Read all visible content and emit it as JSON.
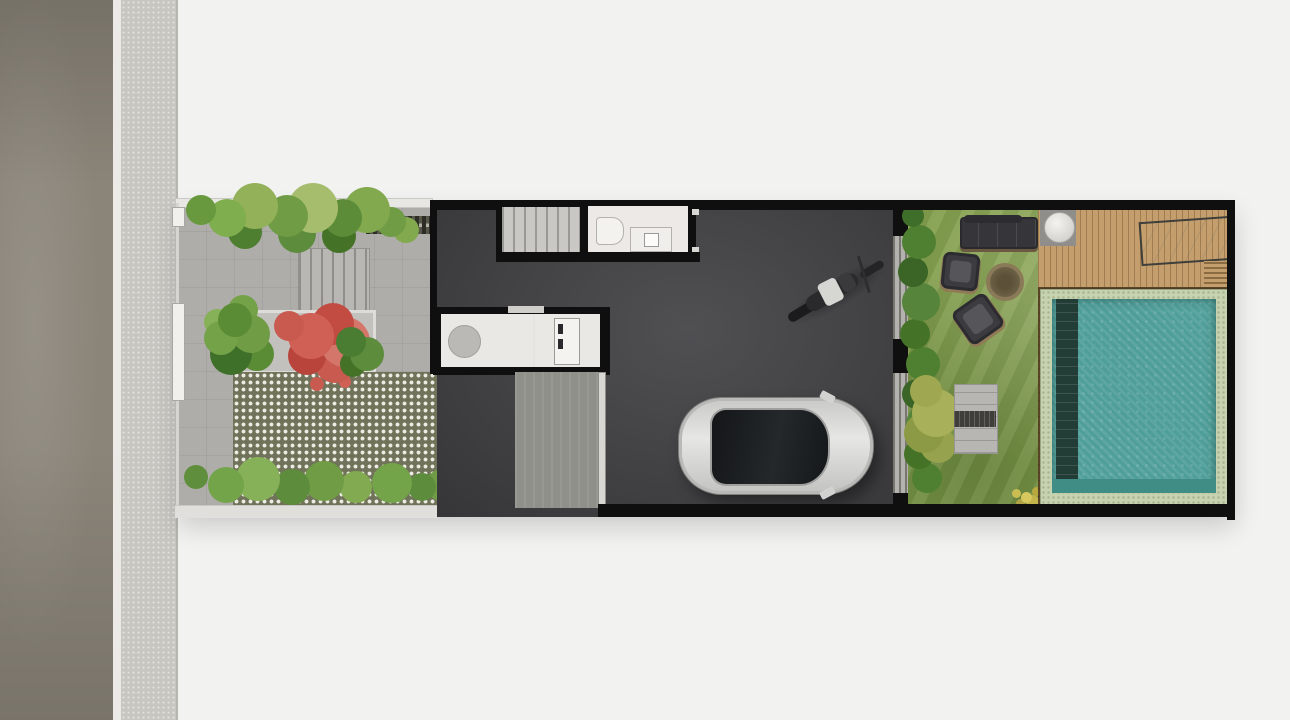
{
  "scene": {
    "title": "townhouse-site-plan-top-view",
    "palette": {
      "background": "#f2f2f1",
      "road": "#8a8479",
      "curb": "#ebeae6",
      "sidewalk": "#c8c6c1",
      "yard_paving": "#aeada9",
      "paver_grid": "#70735a",
      "house_floor": "#454548",
      "wall": "#0f0f0f",
      "stair_tread": "#c9c8c5",
      "bathroom_floor": "#ece9e6",
      "kitchen_counter": "#e9e8e5",
      "driveway": "#90908b",
      "door_track": "#b3b2ae",
      "car_body": "#d8d8d6",
      "car_glass": "#1e2124",
      "grass": "#85a04f",
      "deck_wood": "#c49e6c",
      "pool_coping": "#c7d2b1",
      "pool_water": "#4f9e99",
      "pool_wood_surround": "#5a4426",
      "sofa": "#35353a",
      "red_tree": "#c95a50",
      "foliage": "#6d9a44"
    },
    "objects": [
      "road",
      "sidewalk",
      "front-garden",
      "entry-steps",
      "grass-block-pavers",
      "planter-red-tree",
      "staircase",
      "bathroom",
      "kitchenette",
      "carport",
      "car",
      "motorcycle",
      "sliding-glass-door",
      "backyard-lawn",
      "outdoor-sofa",
      "lounge-chair",
      "fire-pit",
      "garden-steps",
      "wood-deck",
      "round-side-table",
      "marble-daybed",
      "swimming-pool"
    ]
  }
}
